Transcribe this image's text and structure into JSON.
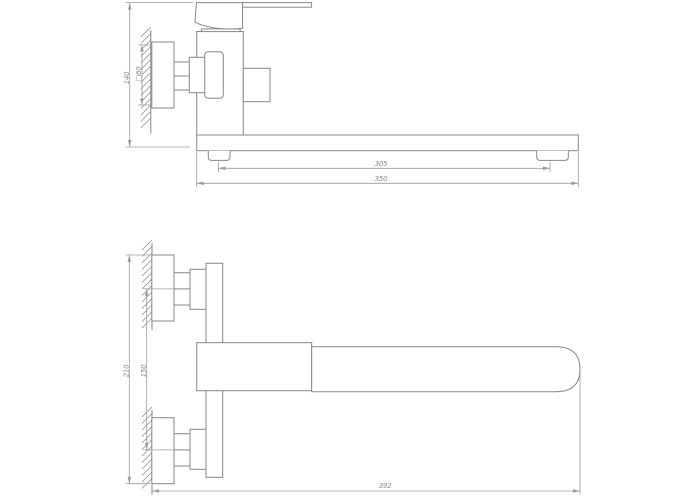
{
  "drawing": {
    "subject": "wall-mounted single-lever bath mixer with long swivel spout, two orthographic views with dimensions"
  },
  "colors": {
    "background": "#ffffff",
    "outline": "#878787",
    "dimension": "#9c9c9c",
    "dimtext": "#8a8a8a"
  },
  "views": {
    "side": {
      "dims": {
        "overall_height": "140",
        "wall_plate_square": "□60",
        "spout_feet_spacing": "305",
        "spout_length": "350"
      }
    },
    "plan": {
      "dims": {
        "overall_span": "210",
        "connection_centers": "150",
        "overall_length": "392"
      }
    }
  }
}
